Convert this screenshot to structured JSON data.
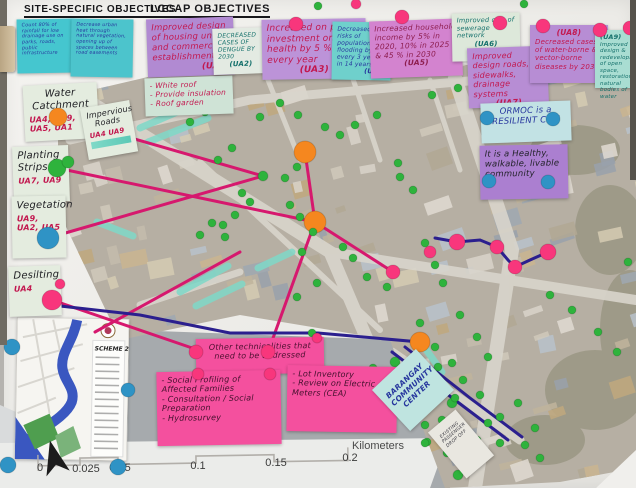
{
  "headers": {
    "site_specific": "SITE-SPECIFIC OBJECTIVES",
    "lccap": "LCCAP OBJECTIVES"
  },
  "notes": {
    "site1": "Count 80% of rainfall for low drainage use on parks, roads, public infrastructure",
    "site2": "Decrease urban heat through natural vegetation, opening up of spaces between road easements",
    "ua1": {
      "text": "Improved design of housing units and commercial establishments",
      "ref": "(UA1)"
    },
    "ua1_actions": [
      "- White roof",
      "- Provide insulation",
      "- Roof garden"
    ],
    "ua2": {
      "text": "DECREASED CASES OF DENGUE BY 2030",
      "ref": "(UA2)"
    },
    "ua3": {
      "text": "Increased on public investment on health by 5 % every year",
      "ref": "(UA3)"
    },
    "ua4": {
      "text": "Decreased risks of population flooding by 1% every 3 years in 14 years",
      "ref": "(UA4)"
    },
    "ua5": {
      "text": "Increased household income by 5% in 2020, 10% in 2025 & 45 % in 2030",
      "ref": "(UA5)"
    },
    "ua6": {
      "text": "Improved cov. of sewerage network",
      "ref": "(UA6)"
    },
    "ua7": {
      "text": "Improved design roads, sidewalks, drainage systems",
      "ref": "(UA7)"
    },
    "ua8": {
      "ref": "(UA8)",
      "text": "Decreased cases of water-borne & vector-borne diseases by 2030"
    },
    "ua9": {
      "ref": "(UA9)",
      "text": "Improved design & redevelopment of open space, restoration of natural bodies of water"
    },
    "water_catchment": {
      "title": "Water Catchment",
      "refs": "UA4, UA9, UA5, UA1"
    },
    "impervious_roads": {
      "title": "Impervious Roads",
      "refs": "UA4 UA9"
    },
    "planting_strips": {
      "title": "Planting Strips",
      "refs": "UA7, UA9"
    },
    "vegetation": {
      "title": "Vegetation",
      "refs": "UA9, UA2, UA5"
    },
    "desilting": {
      "title": "Desilting",
      "refs": "UA4"
    },
    "vision1": "ORMOC is a RESILIENT CITY",
    "vision2": "It is a Healthy, walkable, livable community",
    "tech_header": "Other technicalities that need to be addressed",
    "tech_left": [
      "- Social Profiling of Affected Families",
      "- Consultation / Social Preparation",
      "- Hydrosurvey"
    ],
    "tech_right": [
      "- Lot Inventory",
      "- Review on Electric Meters (CEA)"
    ],
    "community_center": "BARANGAY COMMUNITY CENTER",
    "drop_off": "EXISTING PASSENGER DROP OFF"
  },
  "inset": {
    "label": "SCHEME 2"
  },
  "scalebar": {
    "unit": "Kilometers",
    "ticks": [
      "0",
      "0.025",
      "0.05",
      "0.1",
      "0.15",
      "0.2"
    ]
  },
  "colors": {
    "green": "#2eb33c",
    "red": "#ef2d5e",
    "pink": "#f8367c",
    "orange": "#f5871f",
    "blue": "#2f93c5",
    "magenta": "#d6186e",
    "navy": "#2b1f8e",
    "teal": "#7fd9c8"
  },
  "map_annotations": {
    "strips": [
      [
        [
          140,
          128
        ],
        [
          205,
          100
        ]
      ],
      [
        [
          148,
          142
        ],
        [
          208,
          118
        ]
      ],
      [
        [
          97,
          222
        ],
        [
          133,
          236
        ]
      ],
      [
        [
          180,
          292
        ],
        [
          228,
          266
        ]
      ],
      [
        [
          196,
          306
        ],
        [
          242,
          284
        ]
      ],
      [
        [
          258,
          268
        ],
        [
          292,
          252
        ]
      ],
      [
        [
          425,
          348
        ],
        [
          442,
          372
        ]
      ]
    ],
    "lines": [
      {
        "c": "magenta",
        "w": 3,
        "pts": [
          [
            58,
            117
          ],
          [
            263,
            176
          ]
        ]
      },
      {
        "c": "magenta",
        "w": 3,
        "pts": [
          [
            57,
            168
          ],
          [
            315,
            222
          ]
        ]
      },
      {
        "c": "magenta",
        "w": 3,
        "pts": [
          [
            48,
            238
          ],
          [
            263,
            176
          ]
        ]
      },
      {
        "c": "magenta",
        "w": 3,
        "pts": [
          [
            52,
            300
          ],
          [
            198,
            350
          ]
        ]
      },
      {
        "c": "magenta",
        "w": 3,
        "pts": [
          [
            305,
            152
          ],
          [
            315,
            222
          ]
        ]
      },
      {
        "c": "magenta",
        "w": 3,
        "pts": [
          [
            315,
            222
          ],
          [
            268,
            352
          ]
        ]
      },
      {
        "c": "magenta",
        "w": 3,
        "pts": [
          [
            315,
            222
          ],
          [
            393,
            272
          ]
        ]
      },
      {
        "c": "magenta",
        "w": 3,
        "pts": [
          [
            95,
            332
          ],
          [
            240,
            252
          ]
        ]
      },
      {
        "c": "navy",
        "w": 3,
        "pts": [
          [
            435,
            238
          ],
          [
            457,
            242
          ],
          [
            480,
            240
          ],
          [
            497,
            247
          ],
          [
            508,
            260
          ],
          [
            515,
            267
          ],
          [
            530,
            260
          ],
          [
            548,
            252
          ]
        ]
      },
      {
        "c": "navy",
        "w": 3,
        "pts": [
          [
            60,
            306
          ],
          [
            140,
            315
          ],
          [
            230,
            333
          ],
          [
            318,
            333
          ],
          [
            420,
            342
          ]
        ]
      },
      {
        "c": "navy",
        "w": 3,
        "pts": [
          [
            392,
            352
          ],
          [
            455,
            400
          ],
          [
            508,
            440
          ]
        ]
      },
      {
        "c": "navy",
        "w": 3,
        "pts": [
          [
            405,
            347
          ],
          [
            470,
            398
          ],
          [
            522,
            437
          ]
        ]
      }
    ],
    "dots": [
      [
        305,
        152,
        "orange",
        11
      ],
      [
        315,
        222,
        "orange",
        11
      ],
      [
        420,
        342,
        "orange",
        10
      ],
      [
        393,
        272,
        "pink",
        7
      ],
      [
        430,
        252,
        "pink",
        6
      ],
      [
        457,
        242,
        "pink",
        8
      ],
      [
        497,
        247,
        "pink",
        7
      ],
      [
        515,
        267,
        "pink",
        7
      ],
      [
        548,
        252,
        "pink",
        8
      ],
      [
        280,
        103,
        "green",
        4
      ],
      [
        298,
        115,
        "green",
        4
      ],
      [
        260,
        117,
        "green",
        4
      ],
      [
        325,
        127,
        "green",
        4
      ],
      [
        340,
        135,
        "green",
        4
      ],
      [
        355,
        125,
        "green",
        4
      ],
      [
        377,
        115,
        "green",
        4
      ],
      [
        398,
        163,
        "green",
        4
      ],
      [
        400,
        177,
        "green",
        4
      ],
      [
        263,
        176,
        "green",
        5
      ],
      [
        285,
        178,
        "green",
        4
      ],
      [
        297,
        167,
        "green",
        4
      ],
      [
        242,
        193,
        "green",
        4
      ],
      [
        250,
        202,
        "green",
        4
      ],
      [
        235,
        215,
        "green",
        4
      ],
      [
        223,
        225,
        "green",
        4
      ],
      [
        212,
        223,
        "green",
        4
      ],
      [
        200,
        235,
        "green",
        4
      ],
      [
        225,
        237,
        "green",
        4
      ],
      [
        290,
        205,
        "green",
        4
      ],
      [
        300,
        217,
        "green",
        4
      ],
      [
        313,
        232,
        "green",
        4
      ],
      [
        302,
        252,
        "green",
        4
      ],
      [
        343,
        247,
        "green",
        4
      ],
      [
        353,
        258,
        "green",
        4
      ],
      [
        367,
        277,
        "green",
        4
      ],
      [
        387,
        287,
        "green",
        4
      ],
      [
        317,
        283,
        "green",
        4
      ],
      [
        297,
        297,
        "green",
        4
      ],
      [
        413,
        190,
        "green",
        4
      ],
      [
        425,
        243,
        "green",
        4
      ],
      [
        435,
        265,
        "green",
        4
      ],
      [
        443,
        283,
        "green",
        4
      ],
      [
        420,
        323,
        "green",
        4
      ],
      [
        460,
        315,
        "green",
        4
      ],
      [
        477,
        337,
        "green",
        4
      ],
      [
        488,
        357,
        "green",
        4
      ],
      [
        435,
        347,
        "green",
        4
      ],
      [
        452,
        363,
        "green",
        4
      ],
      [
        452,
        403,
        "green",
        5
      ],
      [
        500,
        417,
        "green",
        4
      ],
      [
        518,
        403,
        "green",
        4
      ],
      [
        535,
        428,
        "green",
        4
      ],
      [
        488,
        423,
        "green",
        4
      ],
      [
        500,
        443,
        "green",
        4
      ],
      [
        458,
        475,
        "green",
        5
      ],
      [
        425,
        425,
        "green",
        4
      ],
      [
        427,
        442,
        "green",
        4
      ],
      [
        442,
        420,
        "green",
        4
      ],
      [
        480,
        395,
        "green",
        4
      ],
      [
        395,
        362,
        "green",
        5
      ],
      [
        413,
        358,
        "green",
        4
      ],
      [
        373,
        368,
        "green",
        4
      ],
      [
        380,
        380,
        "green",
        4
      ],
      [
        438,
        367,
        "green",
        4
      ],
      [
        463,
        380,
        "green",
        4
      ],
      [
        455,
        398,
        "green",
        4
      ],
      [
        447,
        430,
        "green",
        4
      ],
      [
        425,
        443,
        "green",
        4
      ],
      [
        455,
        455,
        "green",
        4
      ],
      [
        477,
        440,
        "green",
        4
      ],
      [
        550,
        295,
        "green",
        4
      ],
      [
        572,
        310,
        "green",
        4
      ],
      [
        598,
        332,
        "green",
        4
      ],
      [
        617,
        352,
        "green",
        4
      ],
      [
        628,
        262,
        "green",
        4
      ],
      [
        432,
        95,
        "green",
        4
      ],
      [
        458,
        88,
        "green",
        4
      ],
      [
        482,
        82,
        "green",
        4
      ],
      [
        505,
        90,
        "green",
        4
      ],
      [
        190,
        122,
        "green",
        4
      ],
      [
        205,
        112,
        "green",
        4
      ],
      [
        312,
        333,
        "green",
        4
      ],
      [
        447,
        453,
        "green",
        4
      ],
      [
        525,
        445,
        "green",
        4
      ],
      [
        540,
        458,
        "green",
        4
      ],
      [
        232,
        148,
        "green",
        4
      ],
      [
        218,
        160,
        "green",
        4
      ]
    ],
    "pins": [
      [
        296,
        24,
        "pink",
        7
      ],
      [
        402,
        17,
        "pink",
        7
      ],
      [
        500,
        23,
        "pink",
        7
      ],
      [
        543,
        26,
        "pink",
        7
      ],
      [
        600,
        30,
        "pink",
        7
      ],
      [
        630,
        28,
        "pink",
        7
      ],
      [
        356,
        4,
        "pink",
        5
      ],
      [
        318,
        6,
        "green",
        4
      ],
      [
        524,
        4,
        "green",
        4
      ],
      [
        317,
        338,
        "pink",
        5
      ],
      [
        196,
        352,
        "pink",
        7
      ],
      [
        268,
        352,
        "pink",
        7
      ],
      [
        198,
        374,
        "pink",
        6
      ],
      [
        270,
        374,
        "pink",
        6
      ],
      [
        60,
        284,
        "pink",
        5
      ],
      [
        52,
        300,
        "pink",
        10
      ],
      [
        58,
        117,
        "orange",
        9
      ],
      [
        57,
        168,
        "green",
        9
      ],
      [
        68,
        162,
        "green",
        6
      ],
      [
        48,
        238,
        "blue",
        11
      ],
      [
        12,
        347,
        "blue",
        8
      ],
      [
        128,
        390,
        "blue",
        7
      ],
      [
        8,
        465,
        "blue",
        8
      ],
      [
        118,
        467,
        "blue",
        8
      ],
      [
        487,
        118,
        "blue",
        7
      ],
      [
        553,
        119,
        "blue",
        7
      ],
      [
        489,
        181,
        "blue",
        7
      ],
      [
        548,
        182,
        "blue",
        7
      ]
    ]
  }
}
